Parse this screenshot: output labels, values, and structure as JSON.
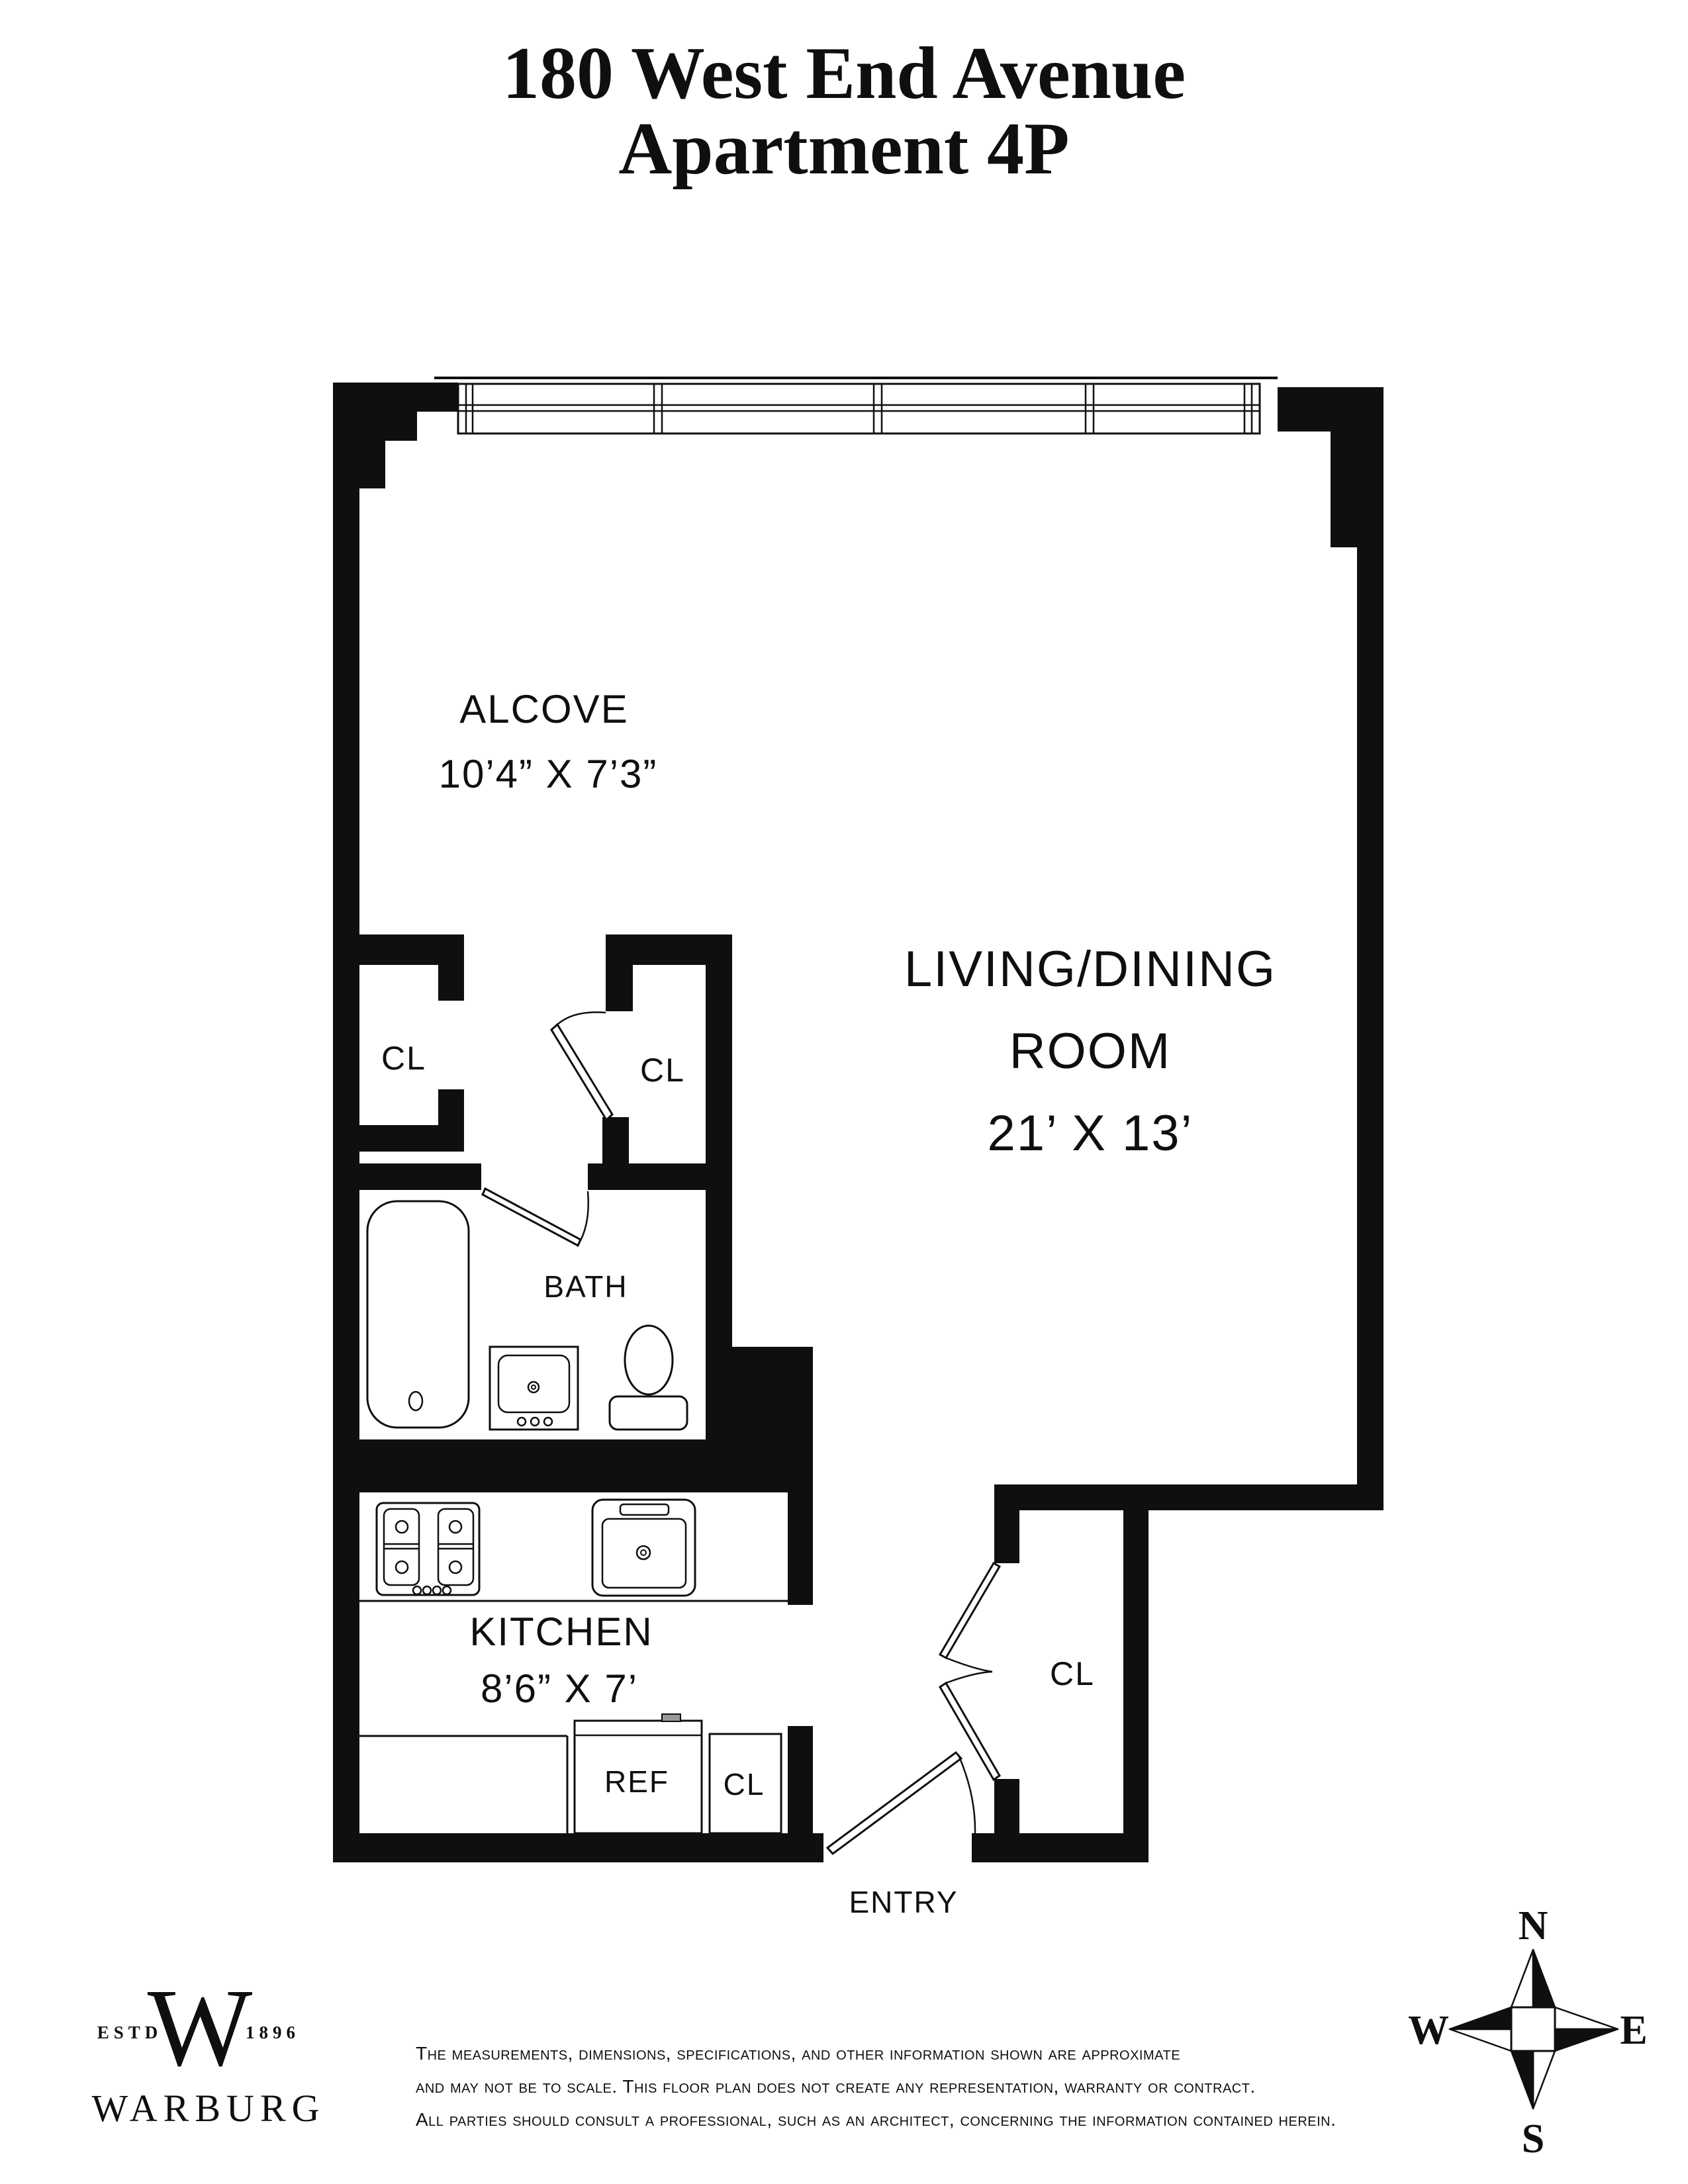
{
  "title": {
    "line1": "180 West End Avenue",
    "line2": "Apartment 4P"
  },
  "rooms": {
    "alcove": {
      "name": "ALCOVE",
      "dims": "10’4” X 7’3”"
    },
    "living": {
      "name_line1": "LIVING/DINING",
      "name_line2": "ROOM",
      "dims": "21’ X 13’"
    },
    "bath": {
      "name": "BATH"
    },
    "kitchen": {
      "name": "KITCHEN",
      "dims": "8’6” X 7’"
    },
    "closet_left": {
      "name": "CL"
    },
    "closet_middle": {
      "name": "CL"
    },
    "closet_kitchen": {
      "name": "CL"
    },
    "closet_entry": {
      "name": "CL"
    },
    "refrigerator": {
      "name": "REF"
    },
    "entry": {
      "name": "ENTRY"
    }
  },
  "branding": {
    "estd": "ESTD",
    "monogram": "W",
    "year": "1896",
    "name": "WARBURG"
  },
  "disclaimer": {
    "line1": "The measurements, dimensions, specifications, and other information shown are approximate",
    "line2": "and may not be to scale. This floor plan does not create any representation, warranty or contract.",
    "line3": "All parties should consult a professional, such as an architect, concerning the information contained herein."
  },
  "compass": {
    "north": "N",
    "south": "S",
    "east": "E",
    "west": "W"
  },
  "colors": {
    "ink": "#0f0f0f",
    "paper": "#ffffff",
    "handle_gray": "#999999"
  }
}
